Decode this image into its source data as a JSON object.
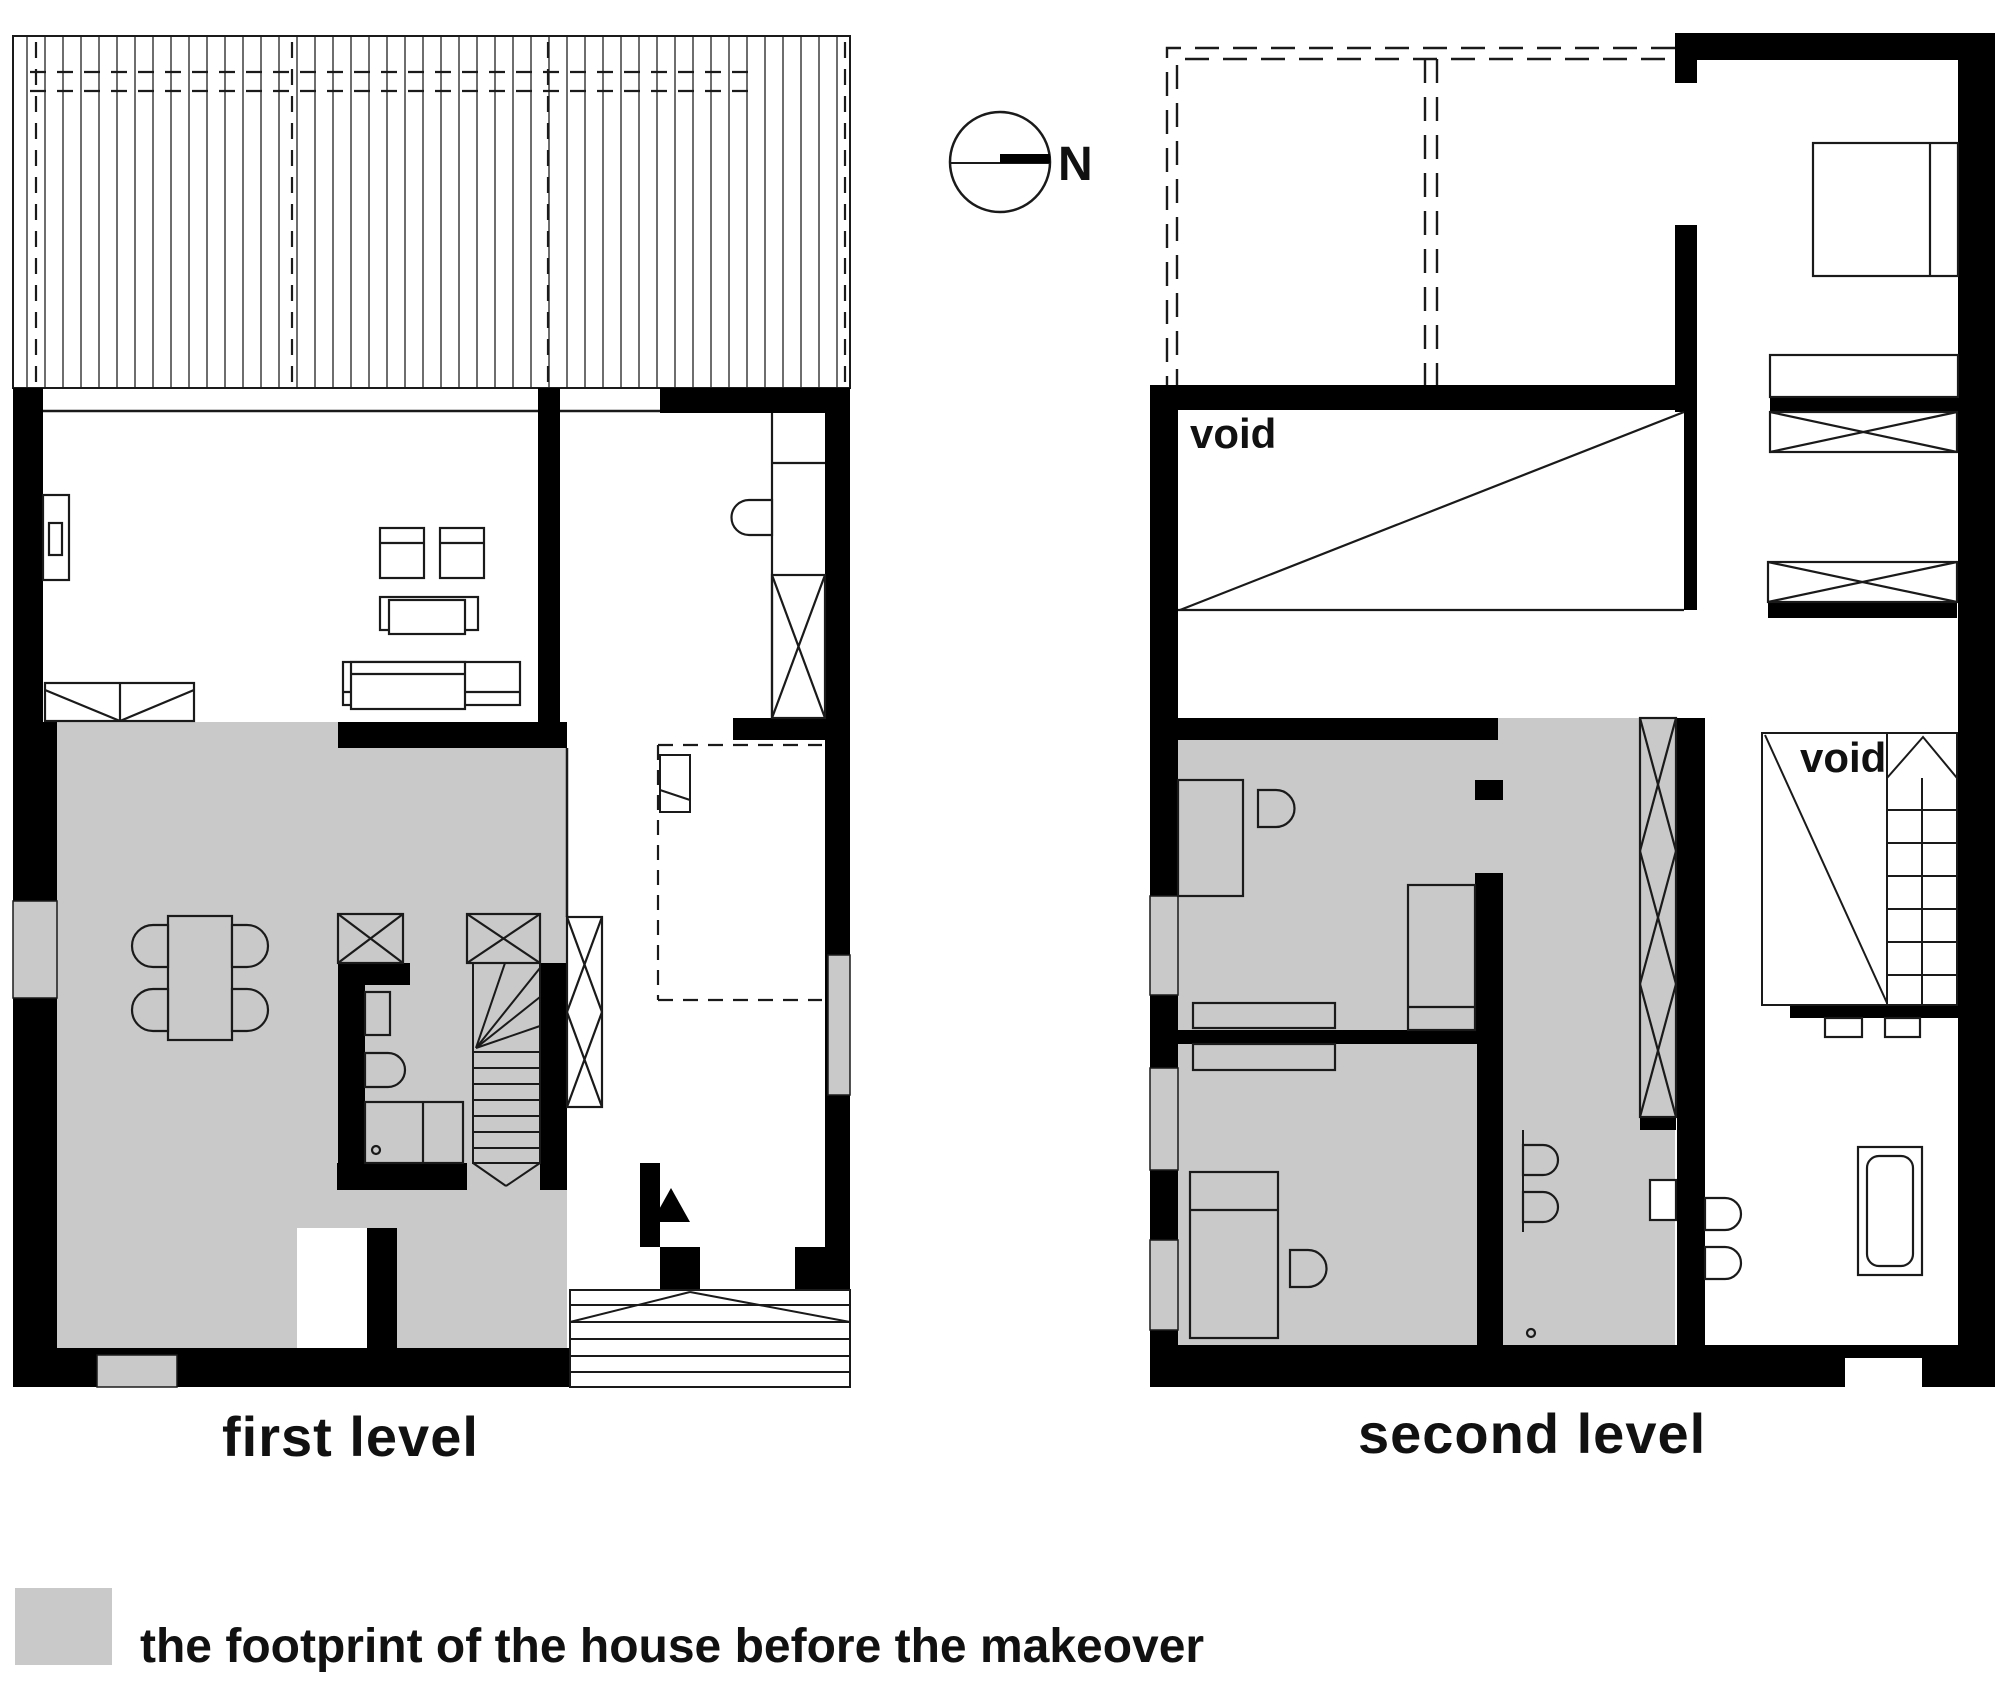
{
  "page": {
    "title": "house makeover floor plans",
    "background": "#ffffff"
  },
  "colors": {
    "wall_black": "#000000",
    "line": "#1a1a1a",
    "footprint_gray": "#c9c9c9",
    "hatch_line": "#2f2f2f"
  },
  "compass": {
    "icon": "north-arrow-icon",
    "north_label": "N"
  },
  "plans": [
    {
      "id": "first-level",
      "label": "first level",
      "features": [
        "hatched roof canopy",
        "living room",
        "kitchen",
        "dining area",
        "wc",
        "shower",
        "winder stair",
        "entry steps",
        "entrance arrow"
      ]
    },
    {
      "id": "second-level",
      "label": "second level",
      "features": [
        "dashed roof terrace outline",
        "bedroom",
        "wardrobes",
        "two voids",
        "stair",
        "bathroom",
        "bathtub"
      ]
    }
  ],
  "annotations": {
    "void_upper": "void",
    "void_stair": "void"
  },
  "legend": {
    "swatch_color": "#c9c9c9",
    "label": "the footprint of the house before the makeover"
  }
}
